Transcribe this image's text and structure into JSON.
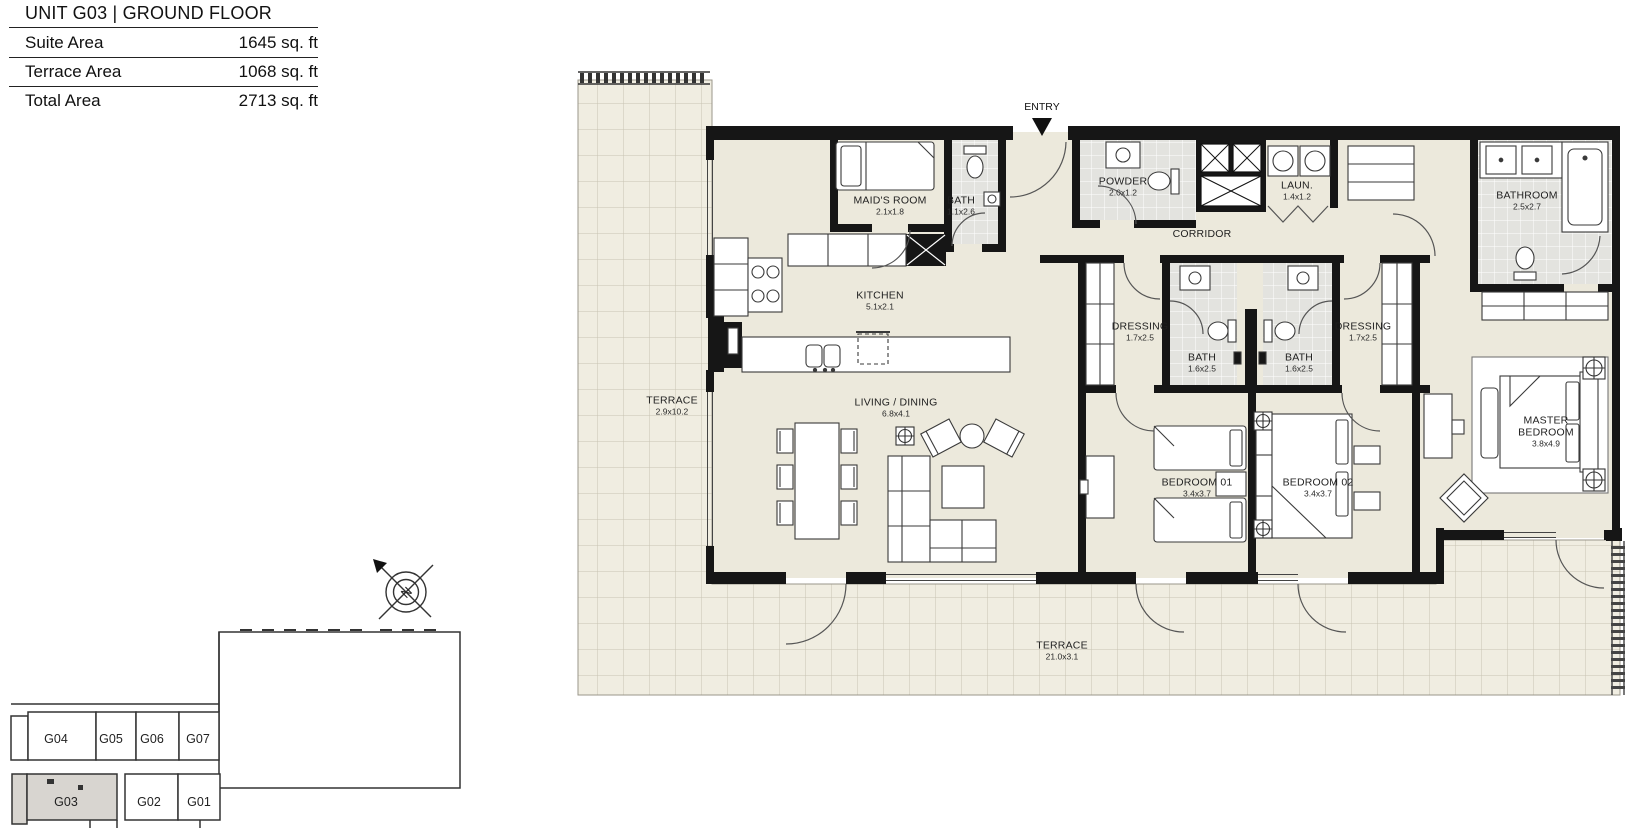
{
  "header": {
    "title": "UNIT G03 | GROUND FLOOR",
    "rows": [
      {
        "label": "Suite Area",
        "value": "1645 sq. ft"
      },
      {
        "label": "Terrace Area",
        "value": "1068 sq. ft"
      },
      {
        "label": "Total Area",
        "value": "2713 sq. ft"
      }
    ]
  },
  "plan": {
    "entry_label": "ENTRY",
    "compass_n": "N",
    "rooms": {
      "maids_room": {
        "name": "MAID'S ROOM",
        "dims": "2.1x1.8"
      },
      "maid_bath": {
        "name": "BATH",
        "dims": "1.1x2.6"
      },
      "powder": {
        "name": "POWDER",
        "dims": "2.0x1.2"
      },
      "laundry": {
        "name": "LAUN.",
        "dims": "1.4x1.2"
      },
      "corridor": {
        "name": "CORRIDOR"
      },
      "bathroom": {
        "name": "BATHROOM",
        "dims": "2.5x2.7"
      },
      "kitchen": {
        "name": "KITCHEN",
        "dims": "5.1x2.1"
      },
      "dressing_left": {
        "name": "DRESSING",
        "dims": "1.7x2.5"
      },
      "bath_left": {
        "name": "BATH",
        "dims": "1.6x2.5"
      },
      "bath_right": {
        "name": "BATH",
        "dims": "1.6x2.5"
      },
      "dressing_right": {
        "name": "DRESSING",
        "dims": "1.7x2.5"
      },
      "terrace_side": {
        "name": "TERRACE",
        "dims": "2.9x10.2"
      },
      "living_dining": {
        "name": "LIVING / DINING",
        "dims": "6.8x4.1"
      },
      "bedroom_01": {
        "name": "BEDROOM 01",
        "dims": "3.4x3.7"
      },
      "bedroom_02": {
        "name": "BEDROOM 02",
        "dims": "3.4x3.7"
      },
      "master_bedroom": {
        "name": "MASTER BEDROOM",
        "dims": "3.8x4.9"
      },
      "terrace_bottom": {
        "name": "TERRACE",
        "dims": "21.0x3.1"
      }
    }
  },
  "key_plan": {
    "units": [
      {
        "label": "G04",
        "highlighted": false
      },
      {
        "label": "G05",
        "highlighted": false
      },
      {
        "label": "G06",
        "highlighted": false
      },
      {
        "label": "G07",
        "highlighted": false
      },
      {
        "label": "G03",
        "highlighted": true
      },
      {
        "label": "G02",
        "highlighted": false
      },
      {
        "label": "G01",
        "highlighted": false
      }
    ]
  },
  "colors": {
    "wall": "#161616",
    "interior_floor": "#ece9dc",
    "terrace_floor": "#f0ede1",
    "wet_floor": "#e3e3df",
    "highlight_unit": "#d8d5d0"
  }
}
